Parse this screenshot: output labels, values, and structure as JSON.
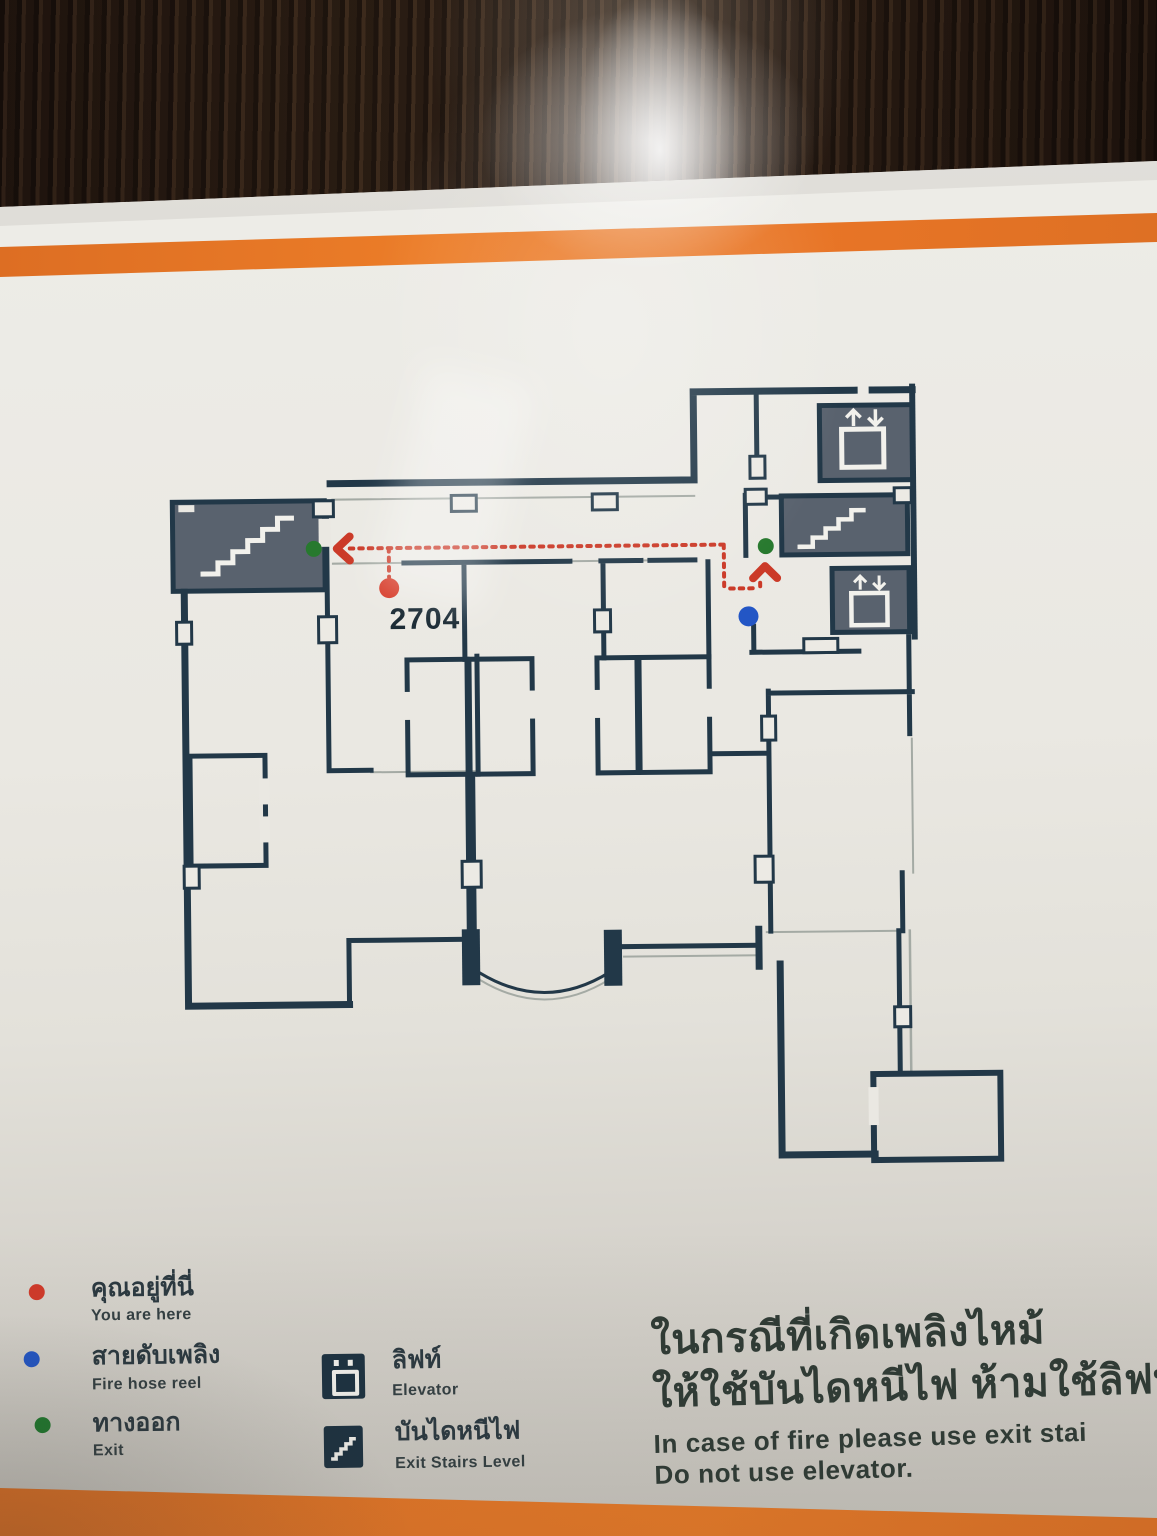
{
  "floor_plan": {
    "room_label": "2704",
    "wall_color": "#223848",
    "service_room_fill": "#59626e",
    "route_color": "#cb3a28"
  },
  "legend": {
    "items": [
      {
        "id": "you-are-here",
        "thai": "คุณอยู่ที่นี่",
        "english": "You are here"
      },
      {
        "id": "fire-hose-reel",
        "thai": "สายดับเพลิง",
        "english": "Fire hose reel"
      },
      {
        "id": "exit",
        "thai": "ทางออก",
        "english": "Exit"
      },
      {
        "id": "elevator",
        "thai": "ลิฟท์",
        "english": "Elevator"
      },
      {
        "id": "exit-stairs",
        "thai": "บันไดหนีไฟ",
        "english": "Exit Stairs Level"
      }
    ]
  },
  "warning": {
    "thai_line1": "ในกรณีที่เกิดเพลิงไหม้",
    "thai_line2": "ให้ใช้บันไดหนีไฟ ห้ามใช้ลิฟท์",
    "english_line1": "In case of fire please use exit stai",
    "english_line2": "Do not use elevator."
  },
  "colors": {
    "accent_orange": "#e87426",
    "sign_background": "#eae8e2",
    "wood_frame": "#2b2016",
    "marker_red": "#d63a28",
    "marker_blue": "#2356c5",
    "marker_green": "#27792e"
  }
}
